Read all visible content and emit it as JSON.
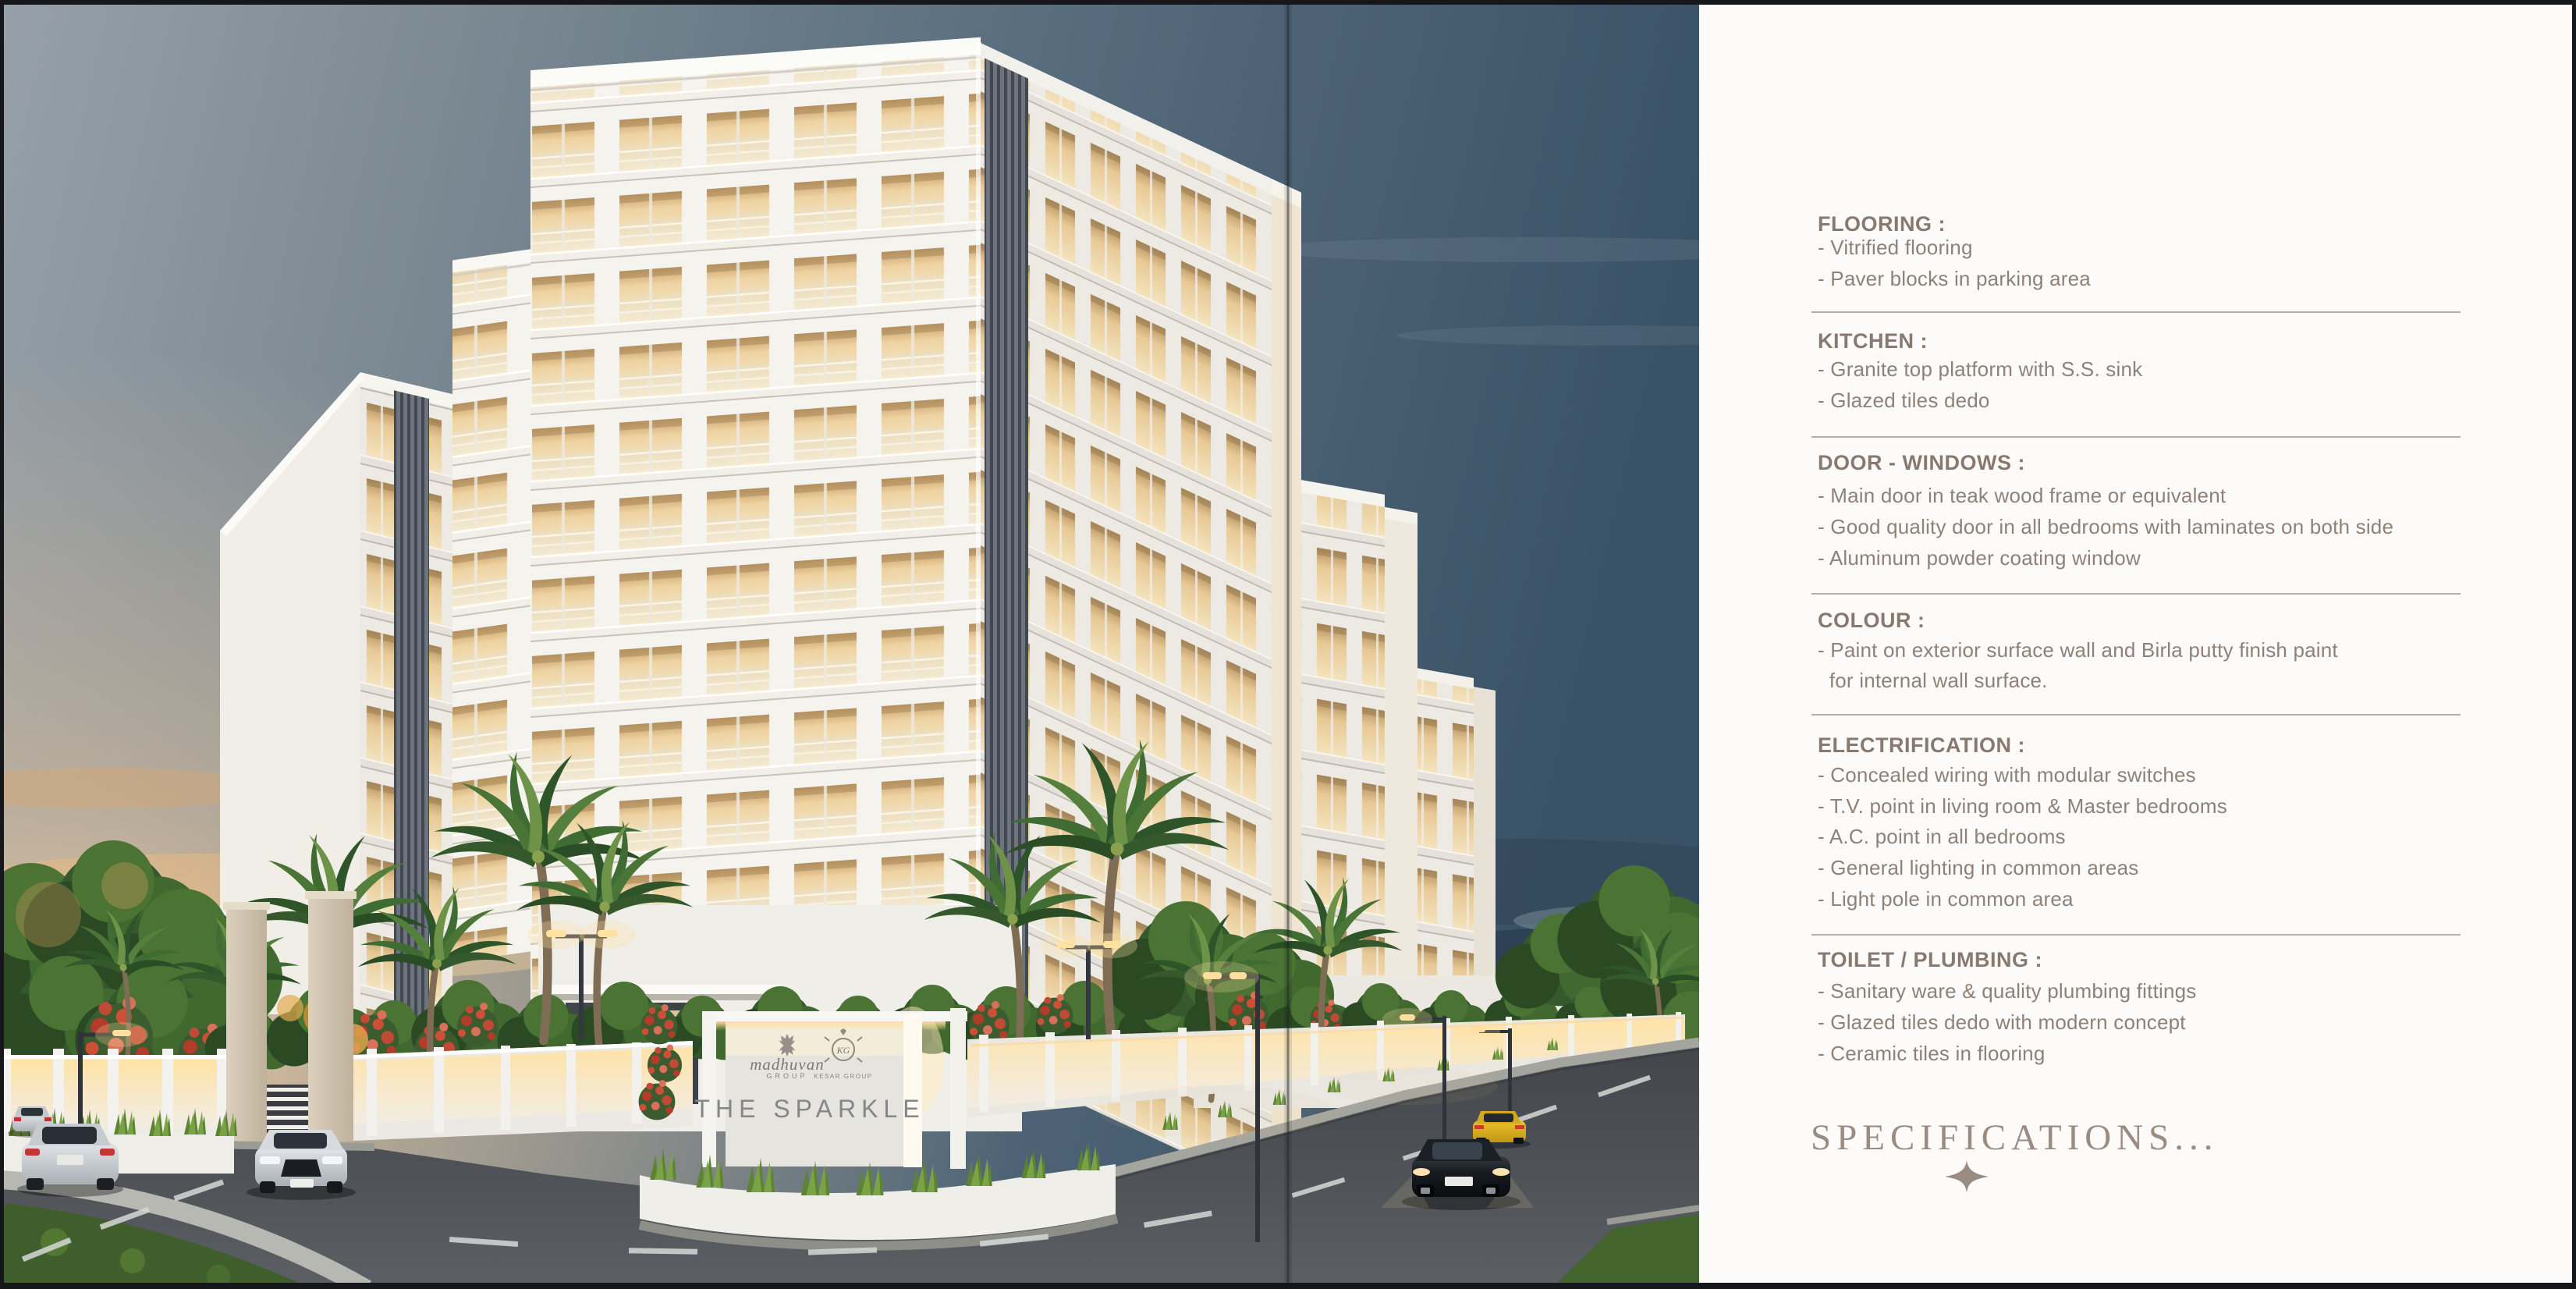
{
  "sign": {
    "brand": "madhuvan",
    "brand_sub": "GROUP",
    "crest_monogram": "KG",
    "crest_caption": "KESAR GROUP",
    "project": "THE SPARKLE"
  },
  "specs": {
    "title": "SPECIFICATIONS...",
    "sections": [
      {
        "heading": "FLOORING :",
        "items": [
          "- Vitrified flooring",
          "- Paver blocks in parking area"
        ]
      },
      {
        "heading": "KITCHEN :",
        "items": [
          "- Granite top platform with S.S. sink",
          "- Glazed tiles dedo"
        ]
      },
      {
        "heading": "DOOR - WINDOWS :",
        "items": [
          "- Main door in teak wood frame or equivalent",
          "- Good quality door in all bedrooms with laminates on both side",
          "- Aluminum powder coating window"
        ]
      },
      {
        "heading": "COLOUR :",
        "items": [
          "- Paint on exterior surface wall and Birla putty finish paint",
          "  for internal wall surface."
        ]
      },
      {
        "heading": "ELECTRIFICATION :",
        "items": [
          "- Concealed wiring with modular switches",
          "- T.V. point in living room & Master bedrooms",
          "- A.C. point in all bedrooms",
          "- General lighting in common areas",
          "- Light pole in common area"
        ]
      },
      {
        "heading": "TOILET / PLUMBING :",
        "items": [
          "- Sanitary ware & quality plumbing fittings",
          "- Glazed tiles dedo with modern concept",
          "- Ceramic tiles in flooring"
        ]
      }
    ]
  },
  "colors": {
    "panel_bg": "#fcfbf9",
    "heading_text": "#887970",
    "item_text": "#8e8179",
    "divider": "#b5afa9",
    "title_text": "#9a8c83",
    "sky_left": "#97a0a8",
    "sky_right": "#3a5266",
    "sunset_glow": "#f3d3a6",
    "window_glow": "#f2ddb0",
    "facade_white": "#f5f3ee",
    "road": "#4b4f54",
    "foliage_green": "#3f6c33",
    "flower_red": "#c04a35"
  }
}
